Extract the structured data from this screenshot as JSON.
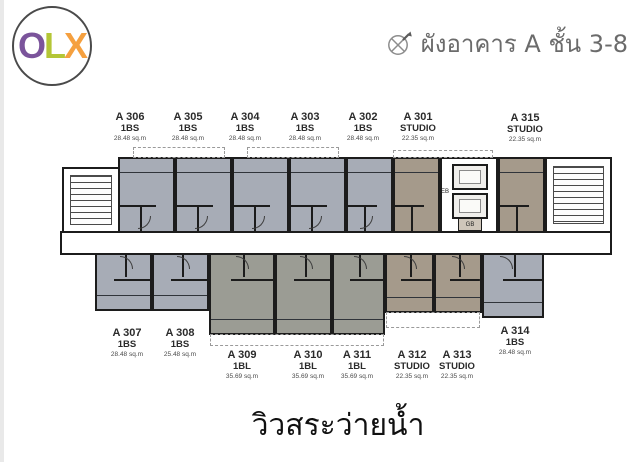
{
  "logo": {
    "letters": [
      {
        "char": "O",
        "color": "#7b549b"
      },
      {
        "char": "L",
        "color": "#b4c636"
      },
      {
        "char": "X",
        "color": "#f5a03f"
      }
    ]
  },
  "header": {
    "title": "ผังอาคาร A ชั้น 3-8",
    "icon": "compass-arrow"
  },
  "footer": {
    "caption": "วิวสระว่ายน้ำ"
  },
  "plan": {
    "wall_color": "#1c1c1c",
    "fill_colors": {
      "unit_1bs_blue_gray": "#a7acb6",
      "unit_1bl_gray": "#9b9c94",
      "unit_studio_tan": "#a59a8b",
      "corridor_white": "#ffffff"
    },
    "core": {
      "eb_label": "EB",
      "gb_label": "GB"
    },
    "units_top": [
      {
        "id": "A 306",
        "type": "1BS",
        "area": "28.48 sq.m"
      },
      {
        "id": "A 305",
        "type": "1BS",
        "area": "28.48 sq.m"
      },
      {
        "id": "A 304",
        "type": "1BS",
        "area": "28.48 sq.m"
      },
      {
        "id": "A 303",
        "type": "1BS",
        "area": "28.48 sq.m"
      },
      {
        "id": "A 302",
        "type": "1BS",
        "area": "28.48 sq.m"
      },
      {
        "id": "A 301",
        "type": "STUDIO",
        "area": "22.35 sq.m"
      },
      {
        "id": "A 315",
        "type": "STUDIO",
        "area": "22.35 sq.m"
      }
    ],
    "units_bottom": [
      {
        "id": "A 307",
        "type": "1BS",
        "area": "28.48 sq.m"
      },
      {
        "id": "A 308",
        "type": "1BS",
        "area": "25.48 sq.m"
      },
      {
        "id": "A 309",
        "type": "1BL",
        "area": "35.69 sq.m"
      },
      {
        "id": "A 310",
        "type": "1BL",
        "area": "35.69 sq.m"
      },
      {
        "id": "A 311",
        "type": "1BL",
        "area": "35.69 sq.m"
      },
      {
        "id": "A 312",
        "type": "STUDIO",
        "area": "22.35 sq.m"
      },
      {
        "id": "A 313",
        "type": "STUDIO",
        "area": "22.35 sq.m"
      },
      {
        "id": "A 314",
        "type": "1BS",
        "area": "28.48 sq.m"
      }
    ]
  }
}
